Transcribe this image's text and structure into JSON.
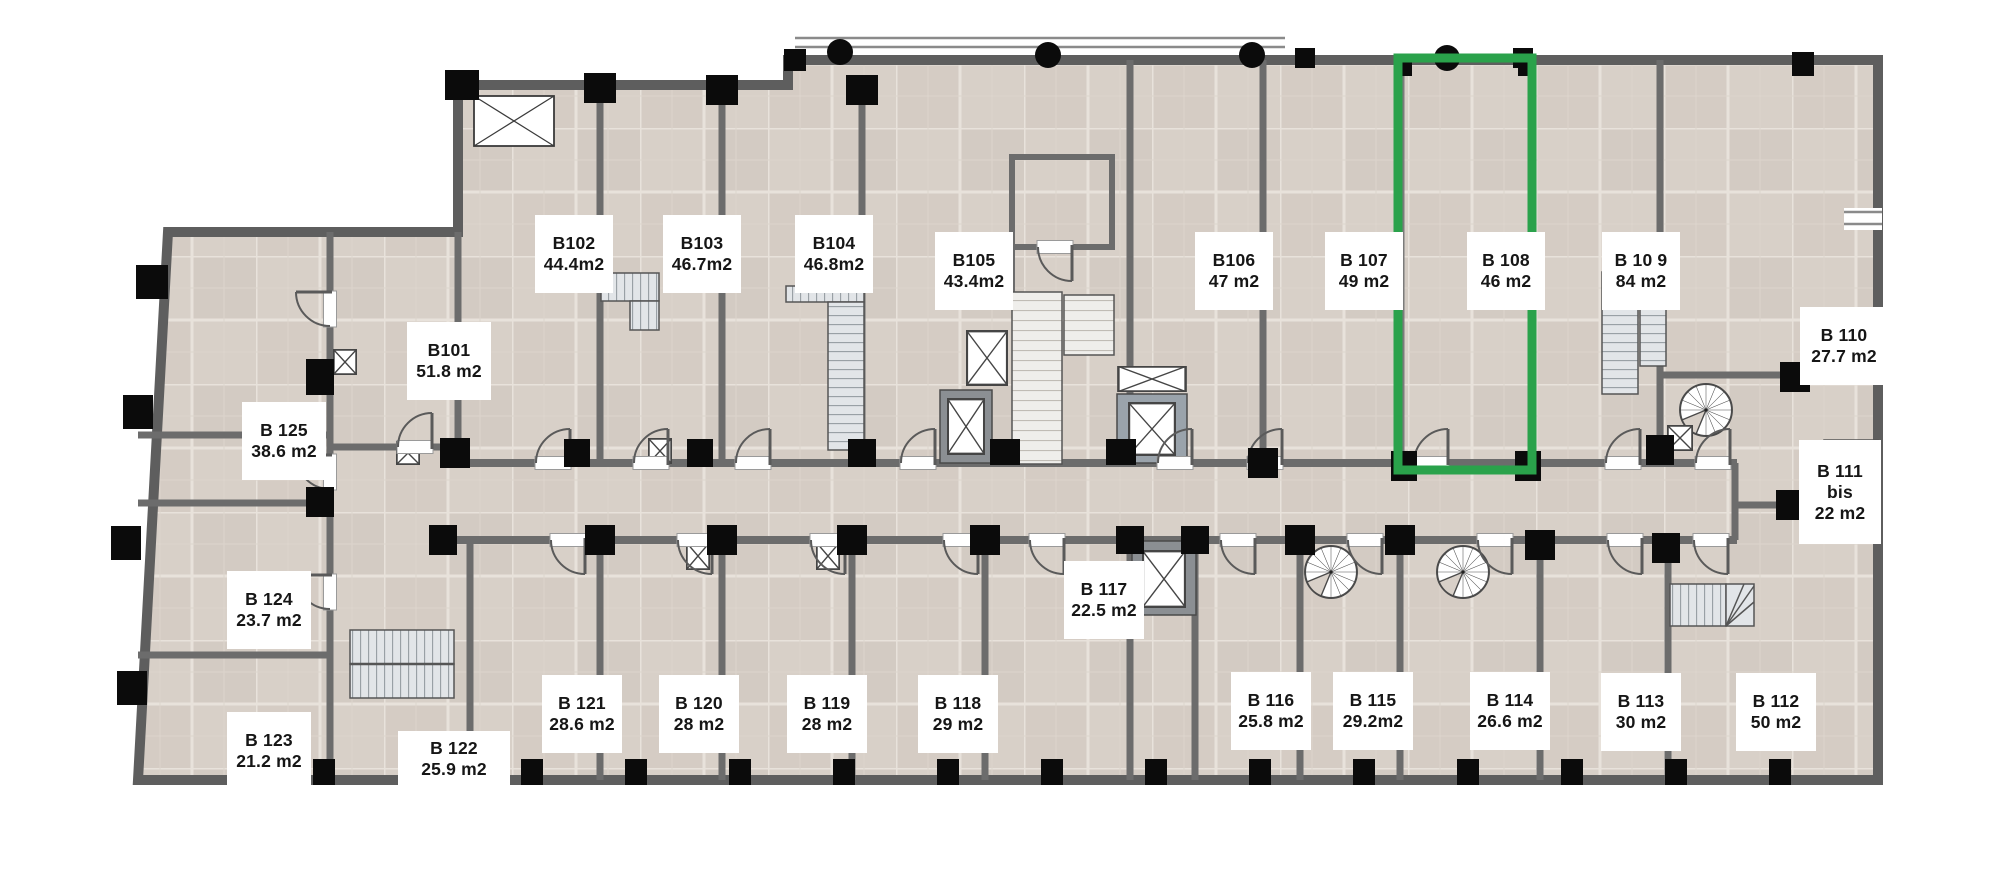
{
  "plan": {
    "title": "Residential floor plan - level B1",
    "highlight": {
      "unit": "B 108",
      "color": "#2aa24b"
    },
    "units": [
      {
        "id": "b102",
        "lines": [
          "B102",
          "44.4m2"
        ],
        "cx": 535,
        "cy": 215,
        "w": 78,
        "h": 78,
        "highlighted": false
      },
      {
        "id": "b103",
        "lines": [
          "B103",
          "46.7m2"
        ],
        "cx": 663,
        "cy": 215,
        "w": 78,
        "h": 78,
        "highlighted": false
      },
      {
        "id": "b104",
        "lines": [
          "B104",
          "46.8m2"
        ],
        "cx": 795,
        "cy": 215,
        "w": 78,
        "h": 78,
        "highlighted": false
      },
      {
        "id": "b105",
        "lines": [
          "B105",
          "43.4m2"
        ],
        "cx": 935,
        "cy": 232,
        "w": 78,
        "h": 78,
        "highlighted": false
      },
      {
        "id": "b106",
        "lines": [
          "B106",
          "47 m2"
        ],
        "cx": 1195,
        "cy": 232,
        "w": 78,
        "h": 78,
        "highlighted": false
      },
      {
        "id": "b107",
        "lines": [
          "B 107",
          "49 m2"
        ],
        "cx": 1325,
        "cy": 232,
        "w": 78,
        "h": 78,
        "highlighted": false
      },
      {
        "id": "b108",
        "lines": [
          "B 108",
          "46 m2"
        ],
        "cx": 1467,
        "cy": 232,
        "w": 78,
        "h": 78,
        "highlighted": true
      },
      {
        "id": "b109",
        "lines": [
          "B 10 9",
          "84 m2"
        ],
        "cx": 1602,
        "cy": 232,
        "w": 78,
        "h": 78,
        "highlighted": false
      },
      {
        "id": "b110",
        "lines": [
          "B 110",
          "27.7 m2"
        ],
        "cx": 1800,
        "cy": 307,
        "w": 88,
        "h": 78,
        "highlighted": false
      },
      {
        "id": "b111bis",
        "lines": [
          "B 111",
          "bis",
          "22 m2"
        ],
        "cx": 1799,
        "cy": 440,
        "w": 82,
        "h": 104,
        "highlighted": false
      },
      {
        "id": "b101",
        "lines": [
          "B101",
          "51.8 m2"
        ],
        "cx": 407,
        "cy": 322,
        "w": 84,
        "h": 78,
        "highlighted": false
      },
      {
        "id": "b125",
        "lines": [
          "B 125",
          "38.6 m2"
        ],
        "cx": 242,
        "cy": 402,
        "w": 84,
        "h": 78,
        "highlighted": false
      },
      {
        "id": "b124",
        "lines": [
          "B 124",
          "23.7 m2"
        ],
        "cx": 227,
        "cy": 571,
        "w": 84,
        "h": 78,
        "highlighted": false
      },
      {
        "id": "b123",
        "lines": [
          "B 123",
          "21.2 m2"
        ],
        "cx": 227,
        "cy": 712,
        "w": 84,
        "h": 78,
        "highlighted": false
      },
      {
        "id": "b122",
        "lines": [
          "B 122",
          "25.9 m2"
        ],
        "cx": 398,
        "cy": 731,
        "w": 112,
        "h": 56,
        "highlighted": false
      },
      {
        "id": "b121",
        "lines": [
          "B 121",
          "28.6 m2"
        ],
        "cx": 542,
        "cy": 675,
        "w": 80,
        "h": 78,
        "highlighted": false
      },
      {
        "id": "b120",
        "lines": [
          "B 120",
          "28 m2"
        ],
        "cx": 659,
        "cy": 675,
        "w": 80,
        "h": 78,
        "highlighted": false
      },
      {
        "id": "b119",
        "lines": [
          "B 119",
          "28 m2"
        ],
        "cx": 787,
        "cy": 675,
        "w": 80,
        "h": 78,
        "highlighted": false
      },
      {
        "id": "b118",
        "lines": [
          "B 118",
          "29 m2"
        ],
        "cx": 918,
        "cy": 675,
        "w": 80,
        "h": 78,
        "highlighted": false
      },
      {
        "id": "b117",
        "lines": [
          "B 117",
          "22.5 m2"
        ],
        "cx": 1064,
        "cy": 561,
        "w": 80,
        "h": 78,
        "highlighted": false
      },
      {
        "id": "b116",
        "lines": [
          "B 116",
          "25.8 m2"
        ],
        "cx": 1231,
        "cy": 672,
        "w": 80,
        "h": 78,
        "highlighted": false
      },
      {
        "id": "b115",
        "lines": [
          "B 115",
          "29.2m2"
        ],
        "cx": 1333,
        "cy": 672,
        "w": 80,
        "h": 78,
        "highlighted": false
      },
      {
        "id": "b114",
        "lines": [
          "B 114",
          "26.6 m2"
        ],
        "cx": 1470,
        "cy": 672,
        "w": 80,
        "h": 78,
        "highlighted": false
      },
      {
        "id": "b113",
        "lines": [
          "B 113",
          "30 m2"
        ],
        "cx": 1601,
        "cy": 673,
        "w": 80,
        "h": 78,
        "highlighted": false
      },
      {
        "id": "b112",
        "lines": [
          "B 112",
          "50 m2"
        ],
        "cx": 1736,
        "cy": 673,
        "w": 80,
        "h": 78,
        "highlighted": false
      }
    ]
  }
}
